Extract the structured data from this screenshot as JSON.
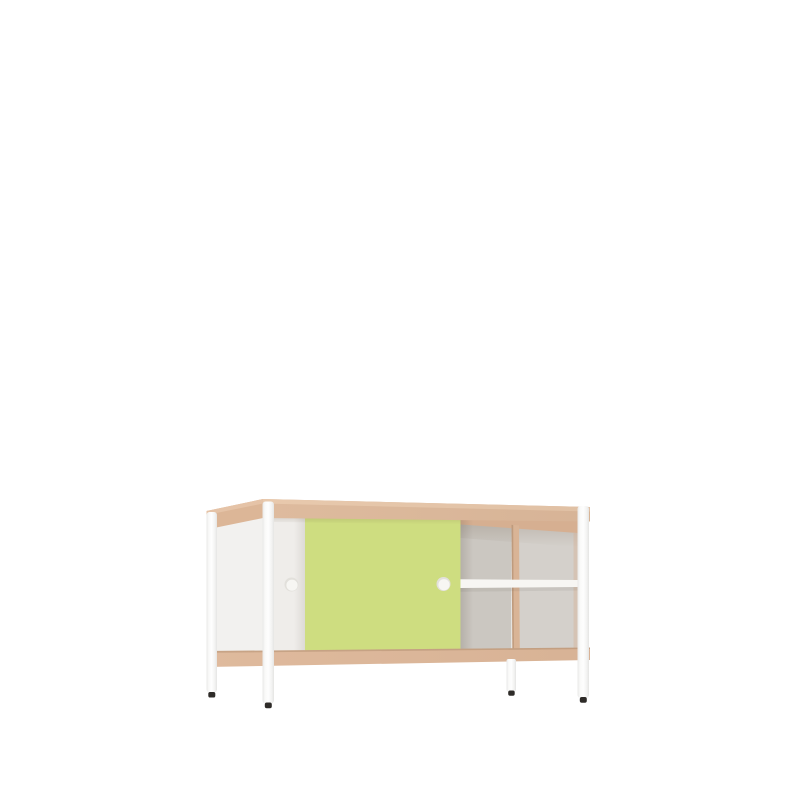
{
  "scene": {
    "type": "product-render",
    "subject": "sideboard with sliding doors on four legs",
    "background": "#ffffff"
  },
  "colors": {
    "background": "#ffffff",
    "wood_frame": "#debb9e",
    "wood_frame_light": "#e8c9ad",
    "wood_side": "#dcb697",
    "wood_side_light": "#e5c3a7",
    "wood_bottom": "#dfba9d",
    "wood_inner": "#d6af91",
    "wood_divider": "#d9b496",
    "door_white": "#efedea",
    "door_green": "#cedd80",
    "side_panel": "#f2f1ef",
    "back_left": "#cbc7c1",
    "back_right": "#d4d0cb",
    "shelf": "#f7f6f3",
    "handle_rim": "#e2e0db",
    "handle_face": "#f7f6f3",
    "leg_cap": "#2e2b28"
  },
  "parts": {
    "top": "wood top rail",
    "bottom": "wood bottom rail",
    "left_door": "white sliding door",
    "right_door": "green sliding door",
    "compartment": "open shelf compartment",
    "legs": "four white legs with dark feet"
  }
}
